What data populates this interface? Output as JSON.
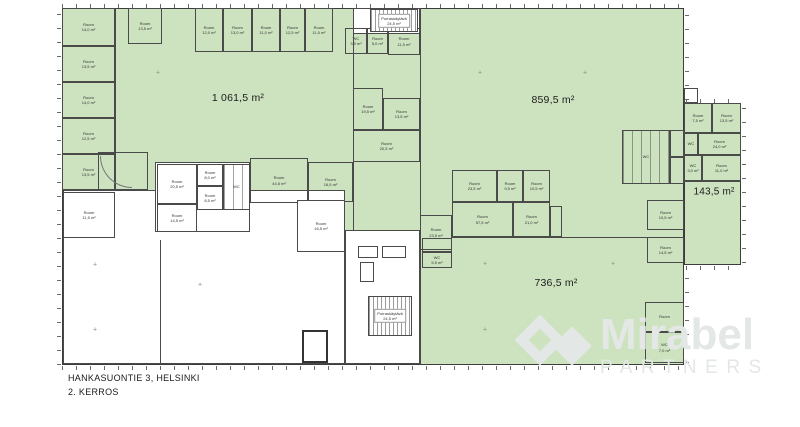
{
  "title": {
    "address": "HANKASUONTIE 3, HELSINKI",
    "floor": "2. KERROS"
  },
  "watermark": {
    "brand": "Mirabel",
    "subtitle": "PARTNERS"
  },
  "colors": {
    "green": "#cde3c0",
    "wall": "#4a4a4a",
    "white": "#ffffff",
    "watermark": "#e3e7e5",
    "label": "#1b1b1b"
  },
  "areas": [
    {
      "name": "area-label-1061",
      "label": "1 061,5 m²",
      "x": 238,
      "y": 98,
      "size": "lg"
    },
    {
      "name": "area-label-859",
      "label": "859,5 m²",
      "x": 553,
      "y": 100,
      "size": "lg"
    },
    {
      "name": "area-label-736",
      "label": "736,5 m²",
      "x": 556,
      "y": 283,
      "size": "lg"
    },
    {
      "name": "area-label-143",
      "label": "143,5 m²",
      "x": 714,
      "y": 192,
      "size": "md"
    }
  ],
  "floorplan": {
    "zones": [
      {
        "name": "main-building",
        "kind": "base",
        "x": 62,
        "y": 8,
        "w": 622,
        "h": 357
      },
      {
        "name": "right-wing",
        "kind": "base",
        "x": 684,
        "y": 103,
        "w": 57,
        "h": 162
      },
      {
        "name": "open-area-southwest",
        "kind": "white",
        "x": 63,
        "y": 190,
        "w": 282,
        "h": 174
      },
      {
        "name": "room-cluster-center",
        "kind": "white",
        "x": 155,
        "y": 162,
        "w": 95,
        "h": 70
      },
      {
        "name": "stair-lobby-south",
        "kind": "white",
        "x": 345,
        "y": 230,
        "w": 75,
        "h": 134
      },
      {
        "name": "stair-block-north",
        "kind": "white",
        "x": 353,
        "y": 8,
        "w": 67,
        "h": 26
      }
    ],
    "rooms": [
      {
        "x": 62,
        "y": 8,
        "w": 53,
        "h": 38,
        "f": "g",
        "label": "Room\n14,0 m²"
      },
      {
        "x": 62,
        "y": 46,
        "w": 53,
        "h": 36,
        "f": "g",
        "label": "Room\n13,5 m²"
      },
      {
        "x": 62,
        "y": 82,
        "w": 53,
        "h": 36,
        "f": "g",
        "label": "Room\n14,0 m²"
      },
      {
        "x": 62,
        "y": 118,
        "w": 53,
        "h": 36,
        "f": "g",
        "label": "Room\n12,5 m²"
      },
      {
        "x": 62,
        "y": 154,
        "w": 53,
        "h": 36,
        "f": "g",
        "label": "Room\n13,5 m²"
      },
      {
        "x": 63,
        "y": 192,
        "w": 52,
        "h": 46,
        "f": "w",
        "label": "Room\n11,5 m²"
      },
      {
        "x": 128,
        "y": 8,
        "w": 34,
        "h": 36,
        "f": "g",
        "label": "Room\n13,5 m²"
      },
      {
        "x": 195,
        "y": 8,
        "w": 28,
        "h": 44,
        "f": "g",
        "label": "Room\n12,0 m²"
      },
      {
        "x": 223,
        "y": 8,
        "w": 29,
        "h": 44,
        "f": "g",
        "label": "Room\n13,0 m²"
      },
      {
        "x": 252,
        "y": 8,
        "w": 28,
        "h": 44,
        "f": "g",
        "label": "Room\n11,0 m²"
      },
      {
        "x": 280,
        "y": 8,
        "w": 25,
        "h": 44,
        "f": "g",
        "label": "Room\n12,5 m²"
      },
      {
        "x": 305,
        "y": 8,
        "w": 28,
        "h": 44,
        "f": "g",
        "label": "Room\n11,5 m²"
      },
      {
        "x": 345,
        "y": 28,
        "w": 22,
        "h": 26,
        "f": "g",
        "label": "WC\n3,5 m²"
      },
      {
        "x": 367,
        "y": 28,
        "w": 21,
        "h": 26,
        "f": "g",
        "label": "Room\n5,0 m²"
      },
      {
        "x": 388,
        "y": 28,
        "w": 32,
        "h": 27,
        "f": "g",
        "label": "Room\n11,5 m²"
      },
      {
        "x": 353,
        "y": 88,
        "w": 30,
        "h": 42,
        "f": "g",
        "label": "Room\n19,5 m²"
      },
      {
        "x": 383,
        "y": 98,
        "w": 37,
        "h": 32,
        "f": "g",
        "label": "Room\n13,5 m²"
      },
      {
        "x": 353,
        "y": 130,
        "w": 67,
        "h": 32,
        "f": "g",
        "label": "Room\n20,5 m²"
      },
      {
        "x": 250,
        "y": 158,
        "w": 58,
        "h": 45,
        "f": "g",
        "label": "Room\n44,5 m²"
      },
      {
        "x": 308,
        "y": 162,
        "w": 45,
        "h": 40,
        "f": "g",
        "label": "Room\n16,5 m²"
      },
      {
        "x": 98,
        "y": 152,
        "w": 50,
        "h": 38,
        "f": "g"
      },
      {
        "x": 157,
        "y": 164,
        "w": 40,
        "h": 40,
        "f": "w",
        "label": "Room\n20,5 m²"
      },
      {
        "x": 197,
        "y": 164,
        "w": 26,
        "h": 22,
        "f": "w",
        "label": "Room\n8,0 m²"
      },
      {
        "x": 197,
        "y": 186,
        "w": 26,
        "h": 24,
        "f": "w",
        "label": "Room\n8,5 m²"
      },
      {
        "x": 223,
        "y": 164,
        "w": 27,
        "h": 46,
        "f": "w",
        "p": "stalls",
        "label": "WC"
      },
      {
        "x": 157,
        "y": 204,
        "w": 40,
        "h": 28,
        "f": "w",
        "label": "Room\n14,5 m²"
      },
      {
        "x": 297,
        "y": 200,
        "w": 48,
        "h": 52,
        "f": "w",
        "label": "Room\n16,5 m²"
      },
      {
        "x": 452,
        "y": 170,
        "w": 45,
        "h": 32,
        "f": "g",
        "label": "Room\n23,5 m²"
      },
      {
        "x": 497,
        "y": 170,
        "w": 26,
        "h": 32,
        "f": "g",
        "label": "Room\n9,5 m²"
      },
      {
        "x": 523,
        "y": 170,
        "w": 27,
        "h": 32,
        "f": "g",
        "label": "Room\n10,5 m²"
      },
      {
        "x": 452,
        "y": 202,
        "w": 61,
        "h": 35,
        "f": "g",
        "label": "Room\n57,5 m²"
      },
      {
        "x": 513,
        "y": 202,
        "w": 37,
        "h": 35,
        "f": "g",
        "label": "Room\n21,0 m²"
      },
      {
        "x": 550,
        "y": 206,
        "w": 12,
        "h": 31,
        "f": "g"
      },
      {
        "x": 420,
        "y": 215,
        "w": 32,
        "h": 35,
        "f": "g",
        "label": "Room\n23,5 m²"
      },
      {
        "x": 622,
        "y": 130,
        "w": 48,
        "h": 54,
        "f": "g",
        "p": "stalls",
        "label": "WC"
      },
      {
        "x": 670,
        "y": 130,
        "w": 14,
        "h": 27,
        "f": "g"
      },
      {
        "x": 670,
        "y": 157,
        "w": 14,
        "h": 27,
        "f": "g"
      },
      {
        "x": 647,
        "y": 200,
        "w": 37,
        "h": 30,
        "f": "g",
        "label": "Room\n10,5 m²"
      },
      {
        "x": 647,
        "y": 237,
        "w": 37,
        "h": 26,
        "f": "g",
        "label": "Room\n14,5 m²"
      },
      {
        "x": 422,
        "y": 238,
        "w": 30,
        "h": 14,
        "f": "g"
      },
      {
        "x": 422,
        "y": 252,
        "w": 30,
        "h": 16,
        "f": "g",
        "label": "WC\n5,5 m²"
      },
      {
        "x": 645,
        "y": 302,
        "w": 39,
        "h": 30,
        "f": "g",
        "label": "Room"
      },
      {
        "x": 645,
        "y": 332,
        "w": 39,
        "h": 31,
        "f": "g",
        "label": "WC\n7,0 m²"
      },
      {
        "x": 684,
        "y": 103,
        "w": 28,
        "h": 30,
        "f": "g",
        "label": "Room\n7,5 m²"
      },
      {
        "x": 712,
        "y": 103,
        "w": 29,
        "h": 30,
        "f": "g",
        "label": "Room\n13,5 m²"
      },
      {
        "x": 684,
        "y": 133,
        "w": 14,
        "h": 22,
        "f": "g",
        "label": "WC"
      },
      {
        "x": 698,
        "y": 133,
        "w": 43,
        "h": 22,
        "f": "g",
        "label": "Room\n24,0 m²"
      },
      {
        "x": 684,
        "y": 155,
        "w": 18,
        "h": 26,
        "f": "g",
        "label": "WC\n3,0 m²"
      },
      {
        "x": 702,
        "y": 155,
        "w": 39,
        "h": 26,
        "f": "g",
        "label": "Room\n11,0 m²"
      },
      {
        "x": 684,
        "y": 88,
        "w": 14,
        "h": 15,
        "f": "g"
      },
      {
        "x": 302,
        "y": 330,
        "w": 26,
        "h": 33,
        "f": "w",
        "p": "box"
      },
      {
        "x": 358,
        "y": 246,
        "w": 20,
        "h": 12,
        "f": "w"
      },
      {
        "x": 382,
        "y": 246,
        "w": 24,
        "h": 12,
        "f": "w"
      },
      {
        "x": 360,
        "y": 262,
        "w": 14,
        "h": 20,
        "f": "w"
      }
    ],
    "stairs": [
      {
        "x": 370,
        "y": 9,
        "w": 48,
        "h": 23,
        "label": "Porraskäytävä\n24,5 m²"
      },
      {
        "x": 368,
        "y": 296,
        "w": 44,
        "h": 40,
        "label": "Porraskäytävä\n24,5 m²"
      }
    ],
    "lines": [
      {
        "x": 420,
        "y": 8,
        "w": 1,
        "h": 357
      },
      {
        "x": 452,
        "y": 237,
        "w": 232,
        "h": 1
      },
      {
        "x": 115,
        "y": 8,
        "w": 1,
        "h": 182
      },
      {
        "x": 353,
        "y": 8,
        "w": 1,
        "h": 222
      },
      {
        "x": 160,
        "y": 240,
        "w": 1,
        "h": 124
      },
      {
        "x": 684,
        "y": 181,
        "w": 57,
        "h": 1
      }
    ],
    "ticks": [
      {
        "x": 62,
        "y": 4,
        "w": 622,
        "h": 4,
        "o": "h"
      },
      {
        "x": 57,
        "y": 8,
        "w": 4,
        "h": 357,
        "o": "v"
      },
      {
        "x": 62,
        "y": 366,
        "w": 622,
        "h": 4,
        "o": "h"
      },
      {
        "x": 685,
        "y": 10,
        "w": 4,
        "h": 90,
        "o": "v"
      },
      {
        "x": 685,
        "y": 268,
        "w": 4,
        "h": 95,
        "o": "v"
      },
      {
        "x": 742,
        "y": 105,
        "w": 4,
        "h": 158,
        "o": "v"
      },
      {
        "x": 686,
        "y": 99,
        "w": 54,
        "h": 4,
        "o": "h"
      },
      {
        "x": 686,
        "y": 266,
        "w": 54,
        "h": 4,
        "o": "h"
      }
    ],
    "columns": [
      {
        "x": 158,
        "y": 73
      },
      {
        "x": 480,
        "y": 73
      },
      {
        "x": 585,
        "y": 73
      },
      {
        "x": 485,
        "y": 264
      },
      {
        "x": 613,
        "y": 264
      },
      {
        "x": 485,
        "y": 330
      },
      {
        "x": 95,
        "y": 265
      },
      {
        "x": 95,
        "y": 330
      },
      {
        "x": 200,
        "y": 285
      }
    ],
    "arcs": [
      {
        "x": 100,
        "y": 156,
        "r": 32
      }
    ]
  }
}
